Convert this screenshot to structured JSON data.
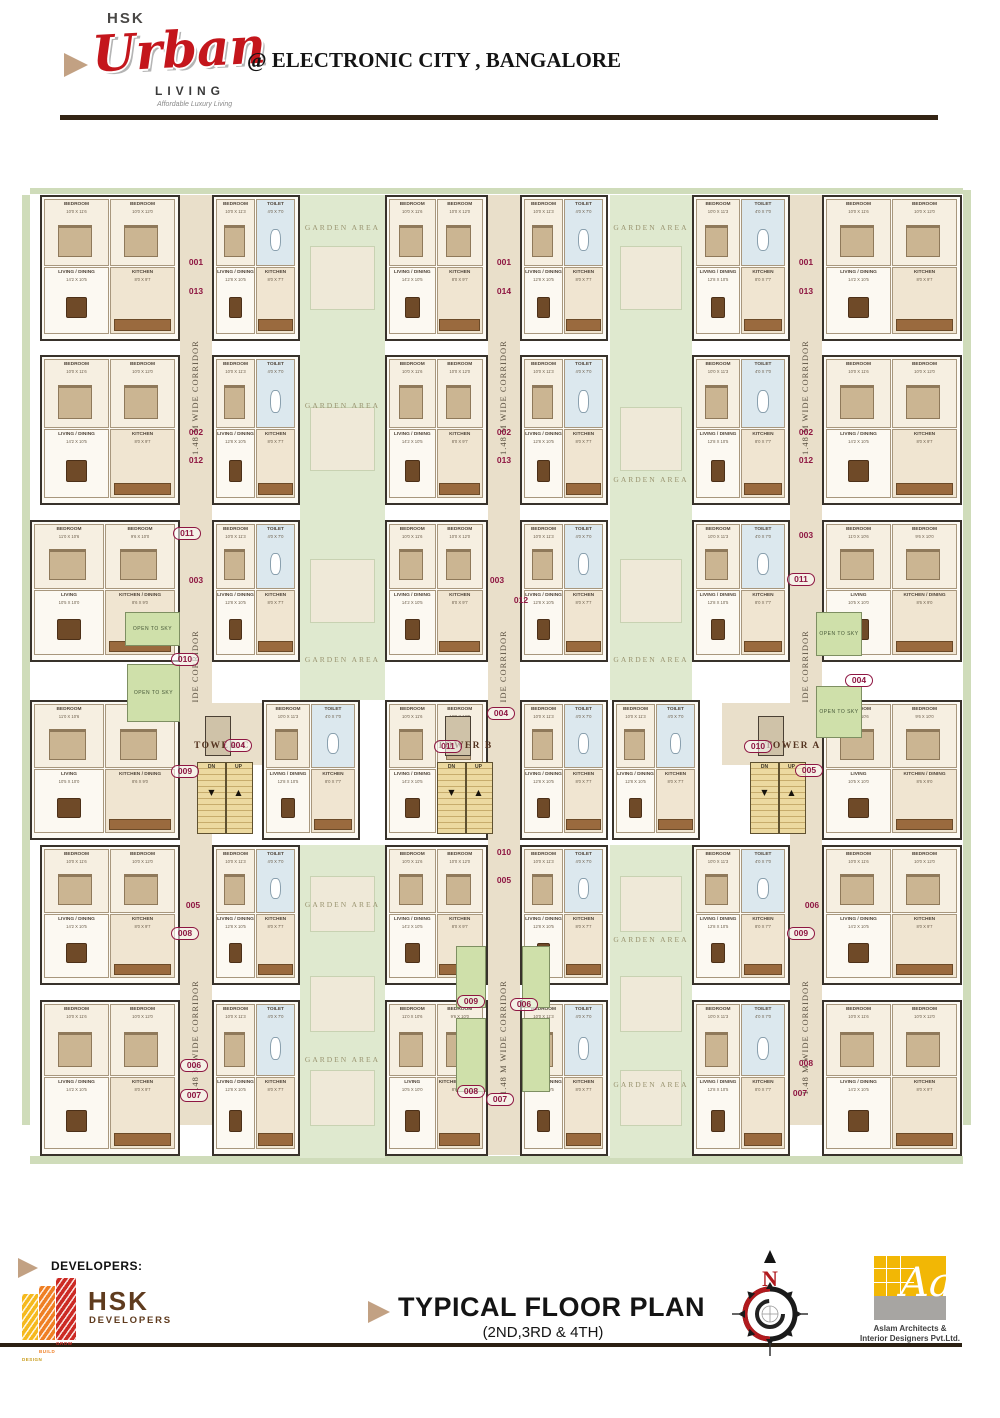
{
  "header": {
    "brand_top": "HSK",
    "brand_script": "Urban",
    "brand_sub": "LIVING",
    "tagline": "Affordable Luxury Living",
    "location": "@ ELECTRONIC CITY , BANGALORE"
  },
  "footer": {
    "developers_label": "DEVELOPERS:",
    "developer_words": [
      "DESIGN",
      "BUILD",
      "GROW"
    ],
    "developer_name": "HSK",
    "developer_name_sub": "DEVELOPERS",
    "title": "TYPICAL FLOOR PLAN",
    "subtitle": "(2ND,3RD & 4TH)",
    "compass_n": "N",
    "architect_mark": "Aa",
    "architect_caption_1": "Aslam Architects &",
    "architect_caption_2": "Interior Designers Pvt.Ltd."
  },
  "colors": {
    "brand_red": "#c4161c",
    "tan": "#c2a183",
    "rule_brown": "#332414",
    "maroon": "#8e1642",
    "corridor": "#e9dfca",
    "garden": "#dfe9cf",
    "hedge": "#cfdcba",
    "open_sky": "#cfe0aa",
    "stair": "#ecd9a0",
    "wall": "#38322b",
    "logo_yellow": "#f5b91e",
    "logo_orange": "#ef7f24",
    "logo_red": "#cc2a24",
    "arch_yellow": "#f2b705",
    "arch_gray": "#a7a5a2",
    "hsk_brown": "#5f3b1e"
  },
  "plan": {
    "corridor_label": "1.48 M WIDE CORRIDOR",
    "garden_label": "GARDEN AREA",
    "open_label": "OPEN TO SKY",
    "stair_dn": "DN",
    "stair_up": "UP",
    "hedges": [
      [
        22,
        195,
        8,
        930
      ],
      [
        963,
        190,
        8,
        935
      ],
      [
        30,
        1156,
        933,
        8
      ],
      [
        30,
        188,
        933,
        6
      ]
    ],
    "gardens": [
      {
        "x": 300,
        "y": 195,
        "w": 85,
        "h": 505,
        "labels": [
          228,
          406,
          660
        ]
      },
      {
        "x": 610,
        "y": 195,
        "w": 82,
        "h": 505,
        "labels": [
          228,
          480,
          660
        ]
      },
      {
        "x": 300,
        "y": 845,
        "w": 85,
        "h": 313,
        "labels": [
          905,
          1060
        ]
      },
      {
        "x": 610,
        "y": 845,
        "w": 82,
        "h": 313,
        "labels": [
          940,
          1085
        ]
      }
    ],
    "corridors": [
      {
        "x": 180,
        "y": 195,
        "w": 32,
        "h": 930,
        "labels": [
          305,
          595,
          945
        ]
      },
      {
        "x": 488,
        "y": 195,
        "w": 32,
        "h": 960,
        "labels": [
          305,
          595,
          945
        ]
      },
      {
        "x": 790,
        "y": 195,
        "w": 32,
        "h": 930,
        "labels": [
          305,
          595,
          945
        ]
      }
    ],
    "lobbies": [
      [
        170,
        703,
        100,
        62
      ],
      [
        410,
        703,
        100,
        62
      ],
      [
        722,
        703,
        100,
        62
      ]
    ],
    "room_sets": {
      "A": [
        {
          "n": "BEDROOM",
          "d": "10'0 X 11'6",
          "t": "bed"
        },
        {
          "n": "BEDROOM",
          "d": "10'0 X 12'0",
          "t": "bed"
        },
        {
          "n": "LIVING / DINING",
          "d": "14'2 X 10'5",
          "t": "liv"
        },
        {
          "n": "KITCHEN",
          "d": "8'0 X 9'7",
          "t": "kit"
        }
      ],
      "B": [
        {
          "n": "BEDROOM",
          "d": "10'0 X 11'3",
          "t": "bed"
        },
        {
          "n": "TOILET",
          "d": "4'0 X 7'0",
          "t": "toi"
        },
        {
          "n": "LIVING / DINING",
          "d": "12'8 X 10'5",
          "t": "liv"
        },
        {
          "n": "KITCHEN",
          "d": "8'0 X 7'7",
          "t": "kit"
        }
      ],
      "C": [
        {
          "n": "BEDROOM",
          "d": "11'0 X 10'6",
          "t": "bed"
        },
        {
          "n": "BEDROOM",
          "d": "9'6 X 10'0",
          "t": "bed"
        },
        {
          "n": "LIVING",
          "d": "10'5 X 10'0",
          "t": "liv"
        },
        {
          "n": "KITCHEN / DINING",
          "d": "8'6 X 9'0",
          "t": "kit"
        }
      ]
    },
    "units": [
      {
        "x": 40,
        "y": 195,
        "w": 140,
        "h": 146,
        "s": "A"
      },
      {
        "x": 212,
        "y": 195,
        "w": 88,
        "h": 146,
        "s": "B"
      },
      {
        "x": 385,
        "y": 195,
        "w": 103,
        "h": 146,
        "s": "A"
      },
      {
        "x": 520,
        "y": 195,
        "w": 88,
        "h": 146,
        "s": "B"
      },
      {
        "x": 692,
        "y": 195,
        "w": 98,
        "h": 146,
        "s": "B"
      },
      {
        "x": 822,
        "y": 195,
        "w": 140,
        "h": 146,
        "s": "A"
      },
      {
        "x": 40,
        "y": 355,
        "w": 140,
        "h": 150,
        "s": "A"
      },
      {
        "x": 212,
        "y": 355,
        "w": 88,
        "h": 150,
        "s": "B"
      },
      {
        "x": 385,
        "y": 355,
        "w": 103,
        "h": 150,
        "s": "A"
      },
      {
        "x": 520,
        "y": 355,
        "w": 88,
        "h": 150,
        "s": "B"
      },
      {
        "x": 692,
        "y": 355,
        "w": 98,
        "h": 150,
        "s": "B"
      },
      {
        "x": 822,
        "y": 355,
        "w": 140,
        "h": 150,
        "s": "A"
      },
      {
        "x": 30,
        "y": 520,
        "w": 150,
        "h": 142,
        "s": "C"
      },
      {
        "x": 212,
        "y": 520,
        "w": 88,
        "h": 142,
        "s": "B"
      },
      {
        "x": 385,
        "y": 520,
        "w": 103,
        "h": 142,
        "s": "A"
      },
      {
        "x": 520,
        "y": 520,
        "w": 88,
        "h": 142,
        "s": "B"
      },
      {
        "x": 692,
        "y": 520,
        "w": 98,
        "h": 142,
        "s": "B"
      },
      {
        "x": 822,
        "y": 520,
        "w": 140,
        "h": 142,
        "s": "C"
      },
      {
        "x": 30,
        "y": 700,
        "w": 150,
        "h": 140,
        "s": "C"
      },
      {
        "x": 262,
        "y": 700,
        "w": 98,
        "h": 140,
        "s": "B"
      },
      {
        "x": 385,
        "y": 700,
        "w": 103,
        "h": 140,
        "s": "A"
      },
      {
        "x": 520,
        "y": 700,
        "w": 88,
        "h": 140,
        "s": "B"
      },
      {
        "x": 612,
        "y": 700,
        "w": 88,
        "h": 140,
        "s": "B"
      },
      {
        "x": 822,
        "y": 700,
        "w": 140,
        "h": 140,
        "s": "C"
      },
      {
        "x": 40,
        "y": 845,
        "w": 140,
        "h": 140,
        "s": "A"
      },
      {
        "x": 212,
        "y": 845,
        "w": 88,
        "h": 140,
        "s": "B"
      },
      {
        "x": 385,
        "y": 845,
        "w": 103,
        "h": 140,
        "s": "A"
      },
      {
        "x": 520,
        "y": 845,
        "w": 88,
        "h": 140,
        "s": "B"
      },
      {
        "x": 692,
        "y": 845,
        "w": 98,
        "h": 140,
        "s": "B"
      },
      {
        "x": 822,
        "y": 845,
        "w": 140,
        "h": 140,
        "s": "A"
      },
      {
        "x": 40,
        "y": 1000,
        "w": 140,
        "h": 156,
        "s": "A"
      },
      {
        "x": 212,
        "y": 1000,
        "w": 88,
        "h": 156,
        "s": "B"
      },
      {
        "x": 385,
        "y": 1000,
        "w": 103,
        "h": 156,
        "s": "C"
      },
      {
        "x": 520,
        "y": 1000,
        "w": 88,
        "h": 156,
        "s": "B"
      },
      {
        "x": 692,
        "y": 1000,
        "w": 98,
        "h": 156,
        "s": "B"
      },
      {
        "x": 822,
        "y": 1000,
        "w": 140,
        "h": 156,
        "s": "A"
      }
    ],
    "stairs": [
      [
        197,
        762,
        56,
        72
      ],
      [
        437,
        762,
        56,
        72
      ],
      [
        750,
        762,
        56,
        72
      ]
    ],
    "shafts": [
      [
        205,
        716,
        26,
        40
      ],
      [
        445,
        716,
        26,
        40
      ],
      [
        758,
        716,
        26,
        40
      ]
    ],
    "open_to_sky": [
      {
        "x": 125,
        "y": 612,
        "w": 55,
        "h": 34,
        "l": 1
      },
      {
        "x": 127,
        "y": 664,
        "w": 53,
        "h": 58,
        "l": 1
      },
      {
        "x": 816,
        "y": 612,
        "w": 46,
        "h": 44,
        "l": 1
      },
      {
        "x": 816,
        "y": 686,
        "w": 46,
        "h": 52,
        "l": 1
      },
      {
        "x": 456,
        "y": 946,
        "w": 30,
        "h": 62,
        "l": 0
      },
      {
        "x": 522,
        "y": 946,
        "w": 28,
        "h": 62,
        "l": 0
      },
      {
        "x": 456,
        "y": 1018,
        "w": 30,
        "h": 74,
        "l": 0
      },
      {
        "x": 522,
        "y": 1018,
        "w": 28,
        "h": 74,
        "l": 0
      }
    ],
    "towers": [
      {
        "label": "TOWER C",
        "x": 222,
        "y": 747
      },
      {
        "label": "TOWER B",
        "x": 465,
        "y": 747
      },
      {
        "label": "TOWER A",
        "x": 793,
        "y": 747
      }
    ],
    "numbers": [
      {
        "t": "001",
        "x": 196,
        "y": 263
      },
      {
        "t": "013",
        "x": 196,
        "y": 292
      },
      {
        "t": "002",
        "x": 196,
        "y": 433
      },
      {
        "t": "012",
        "x": 196,
        "y": 461
      },
      {
        "t": "011",
        "x": 186,
        "y": 533,
        "o": 1
      },
      {
        "t": "003",
        "x": 196,
        "y": 581
      },
      {
        "t": "010",
        "x": 184,
        "y": 659,
        "o": 1
      },
      {
        "t": "004",
        "x": 237,
        "y": 745,
        "o": 1
      },
      {
        "t": "009",
        "x": 184,
        "y": 771,
        "o": 1
      },
      {
        "t": "005",
        "x": 193,
        "y": 906
      },
      {
        "t": "008",
        "x": 184,
        "y": 933,
        "o": 1
      },
      {
        "t": "006",
        "x": 193,
        "y": 1065,
        "o": 1
      },
      {
        "t": "007",
        "x": 193,
        "y": 1095,
        "o": 1
      },
      {
        "t": "001",
        "x": 504,
        "y": 263
      },
      {
        "t": "014",
        "x": 504,
        "y": 292
      },
      {
        "t": "002",
        "x": 504,
        "y": 433
      },
      {
        "t": "013",
        "x": 504,
        "y": 461
      },
      {
        "t": "003",
        "x": 497,
        "y": 581
      },
      {
        "t": "012",
        "x": 521,
        "y": 601
      },
      {
        "t": "004",
        "x": 500,
        "y": 713,
        "o": 1
      },
      {
        "t": "011",
        "x": 447,
        "y": 746,
        "o": 1
      },
      {
        "t": "010",
        "x": 504,
        "y": 853
      },
      {
        "t": "005",
        "x": 504,
        "y": 881
      },
      {
        "t": "009",
        "x": 470,
        "y": 1001,
        "o": 1
      },
      {
        "t": "006",
        "x": 523,
        "y": 1004,
        "o": 1
      },
      {
        "t": "008",
        "x": 470,
        "y": 1091,
        "o": 1
      },
      {
        "t": "007",
        "x": 499,
        "y": 1099,
        "o": 1
      },
      {
        "t": "001",
        "x": 806,
        "y": 263
      },
      {
        "t": "013",
        "x": 806,
        "y": 292
      },
      {
        "t": "002",
        "x": 806,
        "y": 433
      },
      {
        "t": "012",
        "x": 806,
        "y": 461
      },
      {
        "t": "003",
        "x": 806,
        "y": 536
      },
      {
        "t": "011",
        "x": 800,
        "y": 579,
        "o": 1
      },
      {
        "t": "004",
        "x": 858,
        "y": 680,
        "o": 1
      },
      {
        "t": "010",
        "x": 757,
        "y": 746,
        "o": 1
      },
      {
        "t": "005",
        "x": 808,
        "y": 770,
        "o": 1
      },
      {
        "t": "009",
        "x": 800,
        "y": 933,
        "o": 1
      },
      {
        "t": "006",
        "x": 812,
        "y": 906
      },
      {
        "t": "008",
        "x": 806,
        "y": 1064
      },
      {
        "t": "007",
        "x": 800,
        "y": 1094
      }
    ]
  }
}
